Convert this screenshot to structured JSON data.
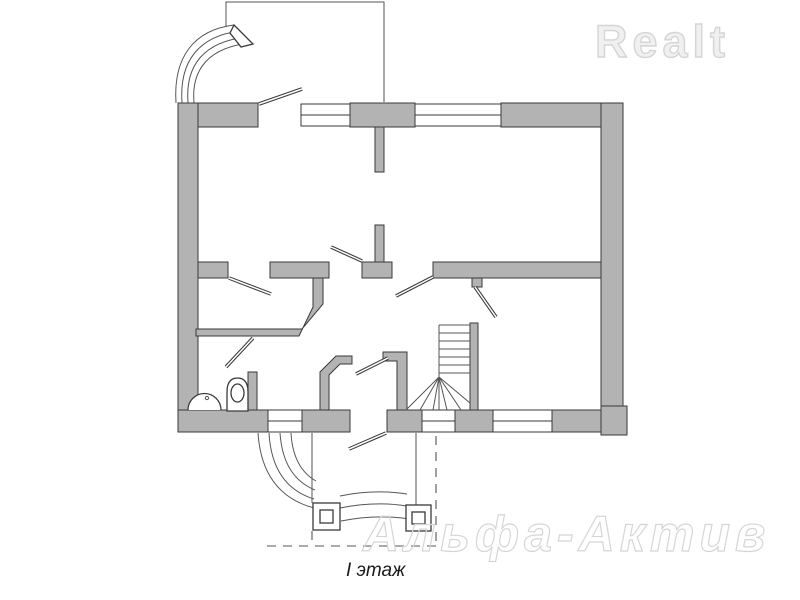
{
  "branding": {
    "logo_text": "Realt",
    "watermark_text": "Альфа-Актив"
  },
  "floorplan": {
    "label": "I этаж",
    "features": {
      "windows": 5,
      "exterior_doors": 2,
      "interior_doors": 6,
      "staircase": "winder-staircase",
      "bathroom_fixtures": [
        "toilet",
        "sink"
      ],
      "porch_columns": 2,
      "curved_step_flights": 2
    }
  },
  "colors": {
    "wall_fill": "#b3b3b3",
    "line": "#3a3a3a",
    "thin_line": "#555555",
    "logo_fill": "#f0f0f0",
    "logo_stroke": "#d5d5d5",
    "watermark_stroke": "#d6d6d6",
    "caption_color": "#1a1a1a"
  }
}
